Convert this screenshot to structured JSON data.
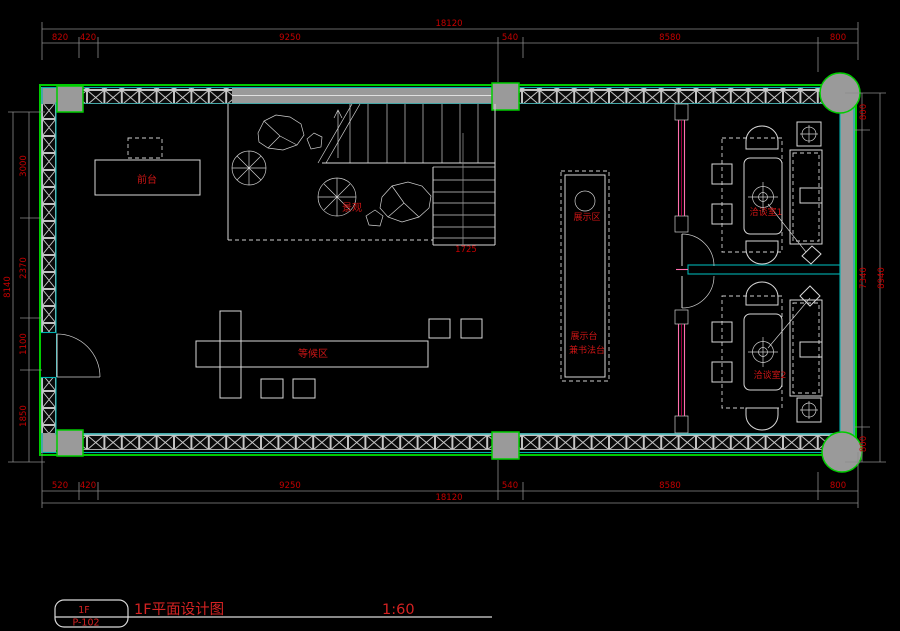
{
  "title_block": {
    "badge_floor": "1F",
    "badge_sheet": "P-102",
    "title": "1F平面设计图",
    "scale": "1:60"
  },
  "labels": {
    "front_desk": "前台",
    "landscape": "景观",
    "display_area": "展示区",
    "display_table_1": "展示台",
    "display_table_2": "兼书法台",
    "waiting_area": "等候区",
    "meeting_room_1": "洽谈室1",
    "meeting_room_2": "洽谈室2",
    "stair_dim": "1725"
  },
  "dimensions": {
    "top": {
      "overall": "18120",
      "segments": [
        "820",
        "420",
        "9250",
        "540",
        "8580",
        "800"
      ]
    },
    "bottom": {
      "overall": "18120",
      "segments": [
        "520",
        "420",
        "9250",
        "540",
        "8580",
        "800"
      ]
    },
    "left": {
      "overall": "8140",
      "segments": [
        "3000",
        "2370",
        "1100",
        "1850"
      ]
    },
    "right": {
      "overall": "8940",
      "segments": [
        "800",
        "7340",
        "800"
      ]
    }
  },
  "colors": {
    "background": "#000000",
    "wall_outline_green": "#00cc00",
    "wall_face_cyan": "#00b2b2",
    "wall_fill_gray": "#9a9a9a",
    "hatch_white": "#d9d9d9",
    "dimension_text_red": "#c40000",
    "label_red": "#cc1515",
    "glass_pink": "#ff6fae",
    "title_red": "#d42222"
  }
}
